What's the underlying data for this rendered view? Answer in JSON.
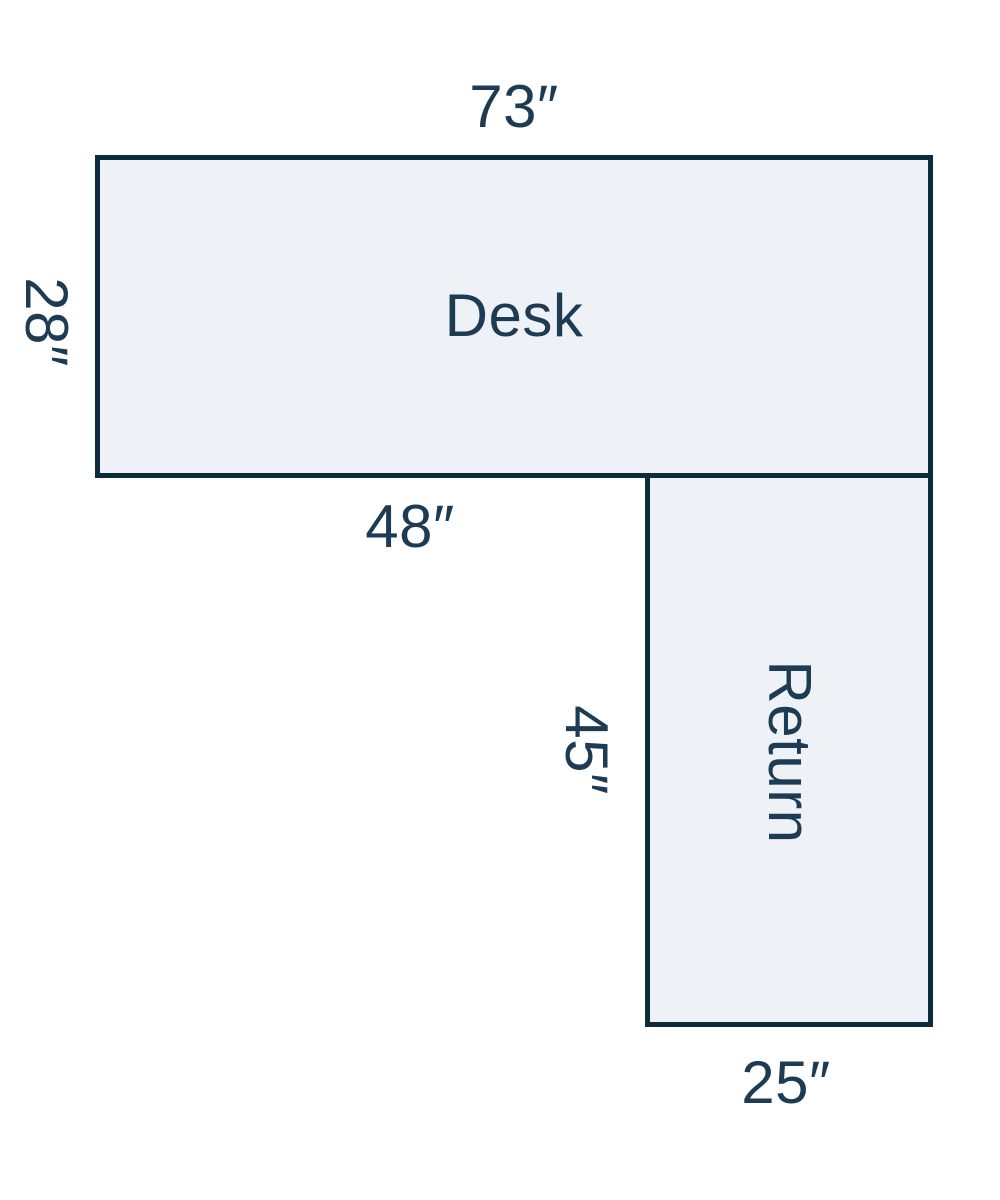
{
  "colors": {
    "outline": "#0e2b3c",
    "fill": "#eef2f6",
    "label": "#1d3c53",
    "background": "#ffffff"
  },
  "desk": {
    "name": "Desk",
    "top_width": "73″",
    "left_depth": "28″",
    "bottom_left_width": "48″"
  },
  "return": {
    "name": "Return",
    "left_depth": "45″",
    "bottom_width": "25″"
  }
}
